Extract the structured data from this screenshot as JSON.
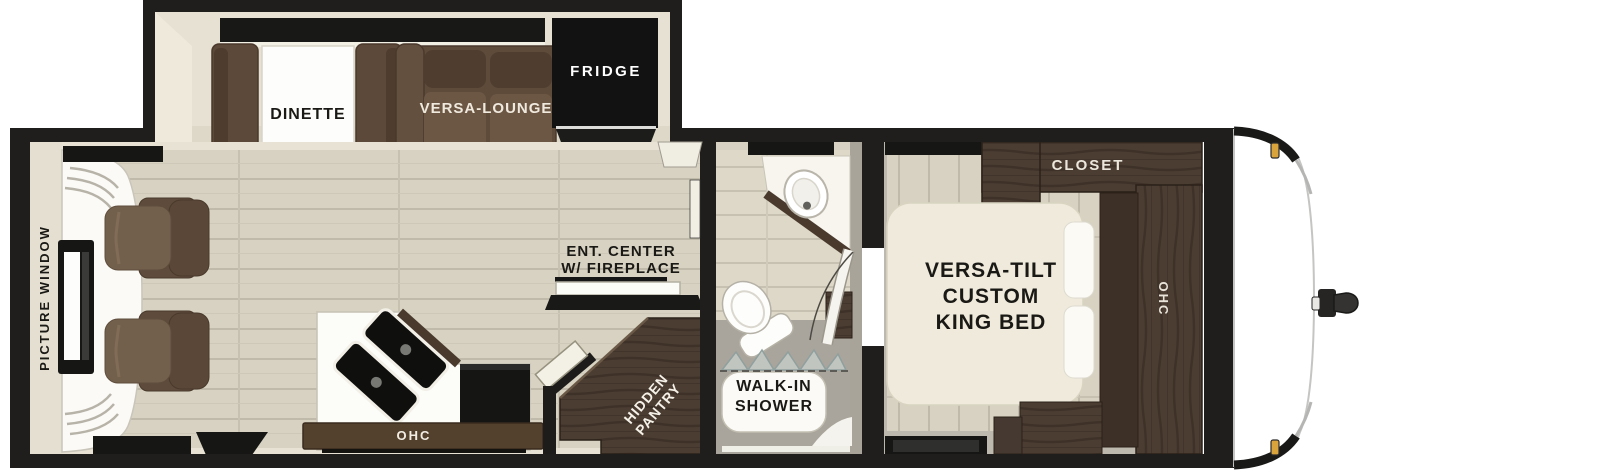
{
  "floorplan": {
    "title": "travel trailer floor plan",
    "labels": {
      "picture_window": "PICTURE WINDOW",
      "dinette": "DINETTE",
      "versa_lounge": "VERSA-LOUNGE",
      "fridge": "FRIDGE",
      "ent_center": {
        "line1": "ENT. CENTER",
        "line2": "W/ FIREPLACE"
      },
      "kitchen_ohc": "OHC",
      "hidden_pantry": {
        "line1": "HIDDEN",
        "line2": "PANTRY"
      },
      "walk_in_shower": {
        "line1": "WALK-IN",
        "line2": "SHOWER"
      },
      "closet": "CLOSET",
      "bedroom_ohc": "OHC",
      "king_bed": {
        "line1": "VERSA-TILT",
        "line2": "CUSTOM",
        "line3": "KING BED"
      }
    },
    "colors": {
      "wall_black": "#1f1e1c",
      "interior_cream": "#e7e2d3",
      "floor_plank": "#d7d2c1",
      "floor_gap": "#bfbaa9",
      "bath_gray": "#a9a59c",
      "bedroom_gray": "#bdb9ae",
      "sofa_brown": "#6b5645",
      "sofa_brown_dark": "#5e4b3b",
      "cabinet_wood": "#4b3d32",
      "cabinet_wood_dark": "#3c3027",
      "ohc_bar_brown": "#53412e",
      "bed_cream": "#efeadb",
      "appliance_black": "#141413",
      "white_fixture": "#fbfaf6",
      "clearance_light_amber": "#d9a43c"
    }
  }
}
